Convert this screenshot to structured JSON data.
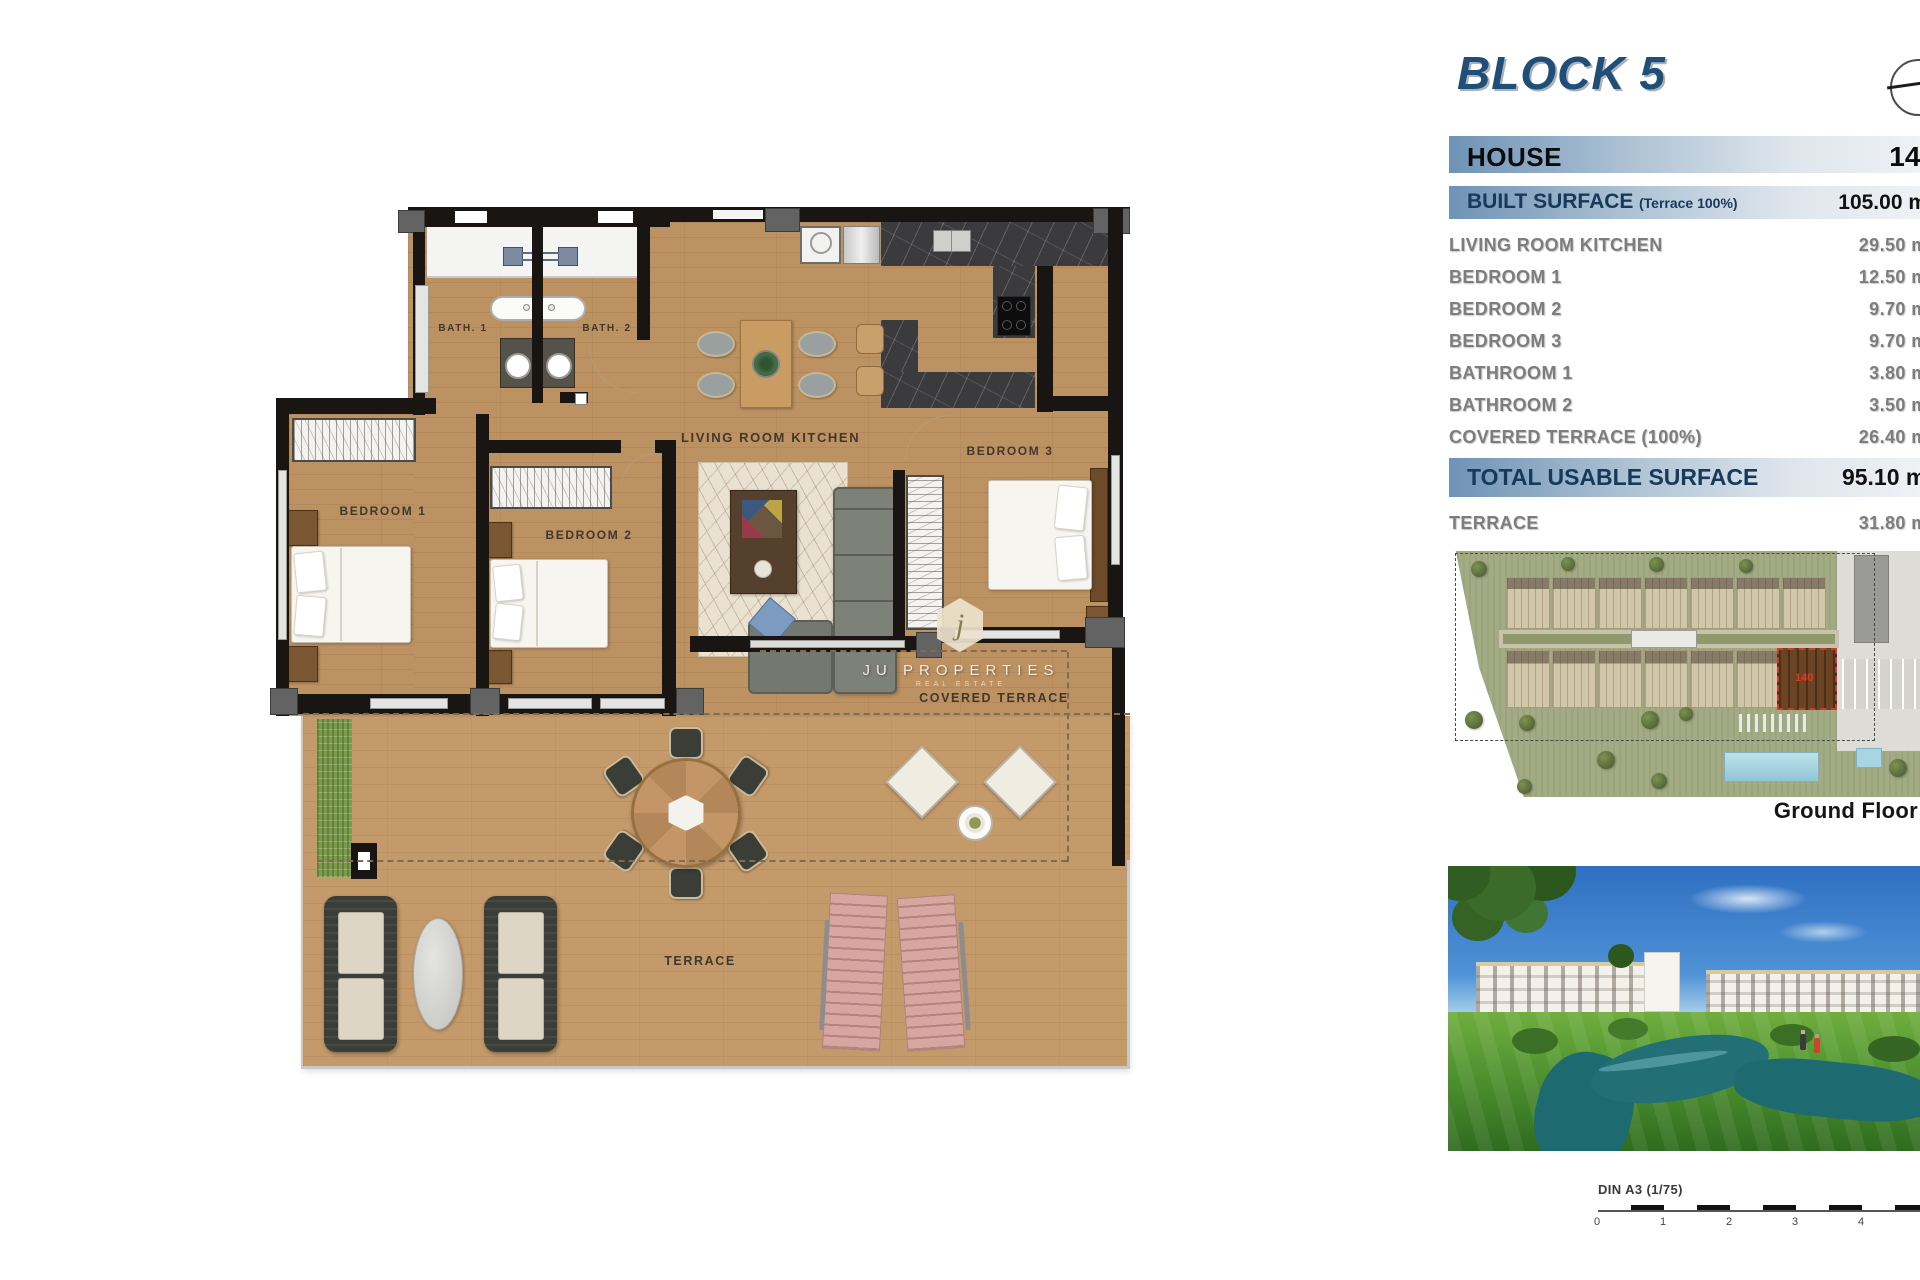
{
  "header": {
    "title": "BLOCK 5"
  },
  "table": {
    "house": {
      "label": "HOUSE",
      "value": "140"
    },
    "built": {
      "label": "BUILT SURFACE",
      "sub": "(Terrace 100%)",
      "value": "105.00 m²"
    },
    "rows": [
      {
        "label": "LIVING ROOM KITCHEN",
        "value": "29.50 m²"
      },
      {
        "label": "BEDROOM 1",
        "value": "12.50 m²"
      },
      {
        "label": "BEDROOM 2",
        "value": "9.70 m²"
      },
      {
        "label": "BEDROOM 3",
        "value": "9.70 m²"
      },
      {
        "label": "BATHROOM 1",
        "value": "3.80 m²"
      },
      {
        "label": "BATHROOM 2",
        "value": "3.50 m²"
      },
      {
        "label": "COVERED TERRACE (100%)",
        "value": "26.40 m²"
      }
    ],
    "total": {
      "label": "TOTAL USABLE SURFACE",
      "value": "95.10 m²"
    },
    "terrace": {
      "label": "TERRACE",
      "value": "31.80 m²"
    }
  },
  "floorplan": {
    "labels": {
      "bath1": "BATH. 1",
      "bath2": "BATH. 2",
      "living": "LIVING ROOM KITCHEN",
      "bedroom1": "BEDROOM 1",
      "bedroom2": "BEDROOM 2",
      "bedroom3": "BEDROOM 3",
      "covered": "COVERED TERRACE",
      "terrace": "TERRACE"
    },
    "watermark": {
      "initial": "j",
      "name": "JU PROPERTIES",
      "sub": "REAL ESTATE"
    }
  },
  "siteplan": {
    "caption": "Ground Floor",
    "highlight_number": "140"
  },
  "scalebar": {
    "label": "DIN A3 (1/75)",
    "ticks": [
      "0",
      "1",
      "2",
      "3",
      "4"
    ]
  },
  "colors": {
    "accent_blue": "#1f4e79",
    "bar_blue": "#6e93b6",
    "wood": "#bd9263",
    "grass_green": "#7c9a4c",
    "pool_blue": "#9fd4e4",
    "highlight_red": "#cf3a2a"
  }
}
